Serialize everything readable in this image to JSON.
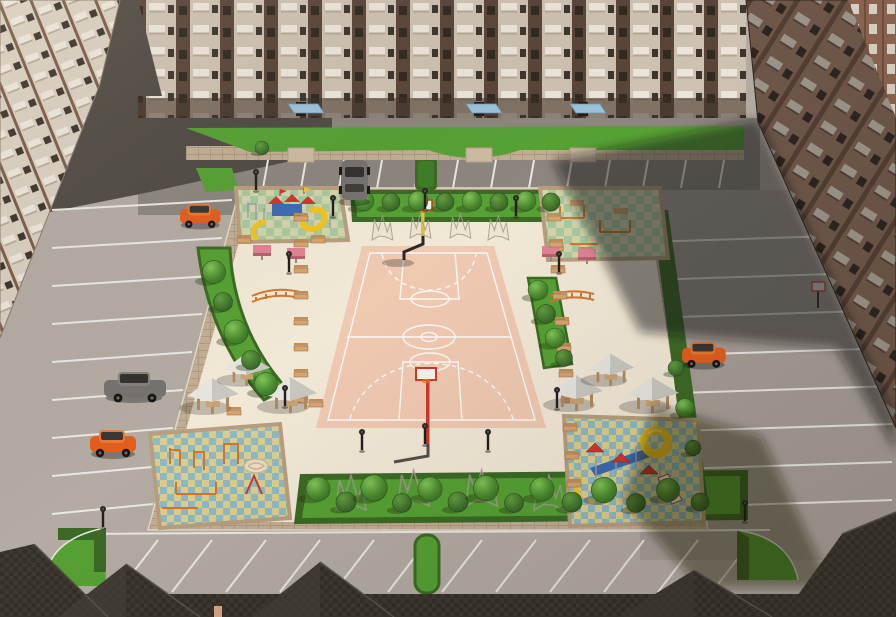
{
  "scene": {
    "description": "Aerial 3D architectural rendering of a landscaped residential courtyard between multi-storey apartment blocks",
    "view": "bird's-eye, looking north",
    "lighting": "sun from upper right; east tower casts a long diagonal shadow across the yard"
  },
  "colors": {
    "asphalt_light": "#b4aba2",
    "asphalt_mid": "#8d867e",
    "asphalt_dark": "#514b45",
    "asphalt_right": "#a79e96",
    "parking_line": "#eae8e2",
    "plaza": "#f2e8d6",
    "court": "#f0c9b1",
    "court_line": "#ffffff",
    "paving": "#c2ae94",
    "lawn": "#56a134",
    "lawn_deep": "#3f7d26",
    "hedge": "#3c6a25",
    "canopy": "#9cc2d8",
    "bench": "#d9a36e",
    "wood": "#b08a5c",
    "gazebo_light": "#e7e5df",
    "gazebo_dark": "#c9c7c0",
    "car_orange": "#e25f1d",
    "car_gray": "#75726f",
    "slide_yellow": "#f2c41d",
    "equip_red": "#cc392b",
    "equip_blue": "#3e6cb0",
    "equip_orange": "#d3762c",
    "equip_frame": "#9aa0a8",
    "table_pink": "#e08394",
    "bld_cream": "#cec2b2",
    "bld_brick": "#5a453a",
    "bld_balcony": "#ebe5da",
    "bld_window": "#3d342c",
    "bldr_wall": "#6e5749",
    "bldr_balcony": "#9c9488",
    "bldr_window": "#2c2520",
    "brick_red": "#8a6450",
    "roof_dark": "#343028",
    "roof_mid": "#3e3931",
    "sand": "#e9ddc1",
    "tiles_green_a": "#d2d4ac",
    "tiles_green_b": "#aac89e",
    "tiles_blue_a": "#8fb9c3",
    "tiles_blue_b": "#dbce8d"
  },
  "objects": {
    "buildings": {
      "north": "long brick-and-cream apartment block with balconies, blue entrance canopies, lawn strip",
      "west": "tall cream apartment block with balcony grid",
      "east": "apartment tower in shade with balcony rows",
      "foreground": "dark shingled gable rooftops of lower buildings"
    },
    "basketball_court": {
      "surface": "peach",
      "markings": "white border, centre circle, keys, dashed three-point arcs",
      "hoops": 2
    },
    "playgrounds": [
      {
        "position": "north-west",
        "type": "children playset with yellow slides on green checker tiles"
      },
      {
        "position": "north-east",
        "type": "fitness area with bars and tables, partly in shadow"
      },
      {
        "position": "south-west",
        "type": "orange workout frames on blue-yellow checker tiles"
      },
      {
        "position": "south-east",
        "type": "playset with yellow tube slide on blue-yellow checker tiles"
      }
    ],
    "gazebos": {
      "west_group": 3,
      "east_group": 3
    },
    "table_tennis_tables": 4,
    "vehicles": [
      {
        "type": "hatchback",
        "color_key": "car_orange",
        "location": "west parking"
      },
      {
        "type": "sedan",
        "color_key": "car_gray",
        "location": "west parking"
      },
      {
        "type": "hatchback",
        "color_key": "car_orange",
        "location": "north-west parking"
      },
      {
        "type": "sedan",
        "color_key": "car_gray",
        "location": "north parking row"
      },
      {
        "type": "hatchback",
        "color_key": "car_orange",
        "location": "east parking"
      }
    ],
    "vegetation": {
      "sphere_trees": 34,
      "hedge_strips": 6,
      "corner_lawns": 2,
      "sketch_wireframe_trees": 8
    },
    "street_furniture": {
      "benches": 23,
      "lamp_posts": 13
    }
  }
}
